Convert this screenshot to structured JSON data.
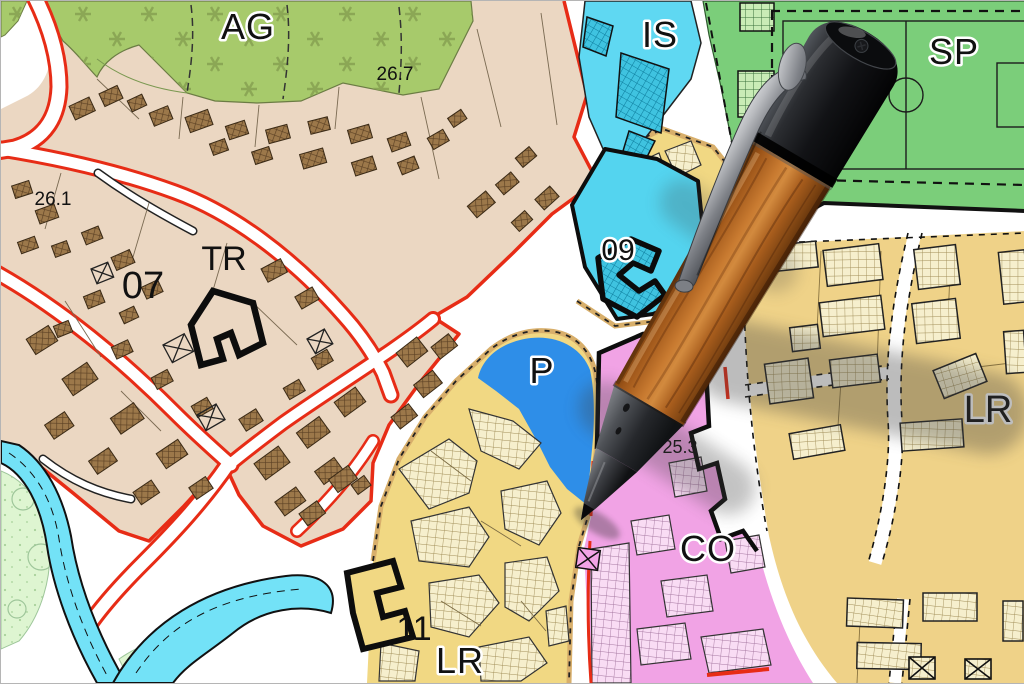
{
  "map": {
    "zones": {
      "ag": {
        "code": "AG",
        "area_value": "26.7",
        "color": "#a7ca6b"
      },
      "old_town": {
        "district_number": "07",
        "transport_code": "TR",
        "area_value": "26.1",
        "color": "#ebd7c2"
      },
      "is": {
        "code": "IS",
        "color": "#5fd8f2"
      },
      "sp": {
        "code": "SP",
        "color": "#7bce7a"
      },
      "d09": {
        "code": "09",
        "color": "#54d4ef"
      },
      "p": {
        "code": "P",
        "color": "#2e8ee8"
      },
      "lr_bottom": {
        "code": "LR",
        "district_number": "11",
        "color": "#f1d883"
      },
      "lr_right": {
        "code": "LR",
        "color": "#efd288"
      },
      "co": {
        "code": "CO",
        "area_value": "25.3",
        "color": "#f1a3e5"
      }
    },
    "legend_colors": {
      "water": "#73e2f7",
      "park": "#def5d1",
      "road_boundary_red": "#e72c16",
      "building_brown": "#9c784a",
      "zone_border_tan": "#d8af6b"
    }
  },
  "pen": {
    "cap": "#121316",
    "wood": "#b4671f",
    "grip": "#3b3d41",
    "clip": "#a7a9ae"
  }
}
